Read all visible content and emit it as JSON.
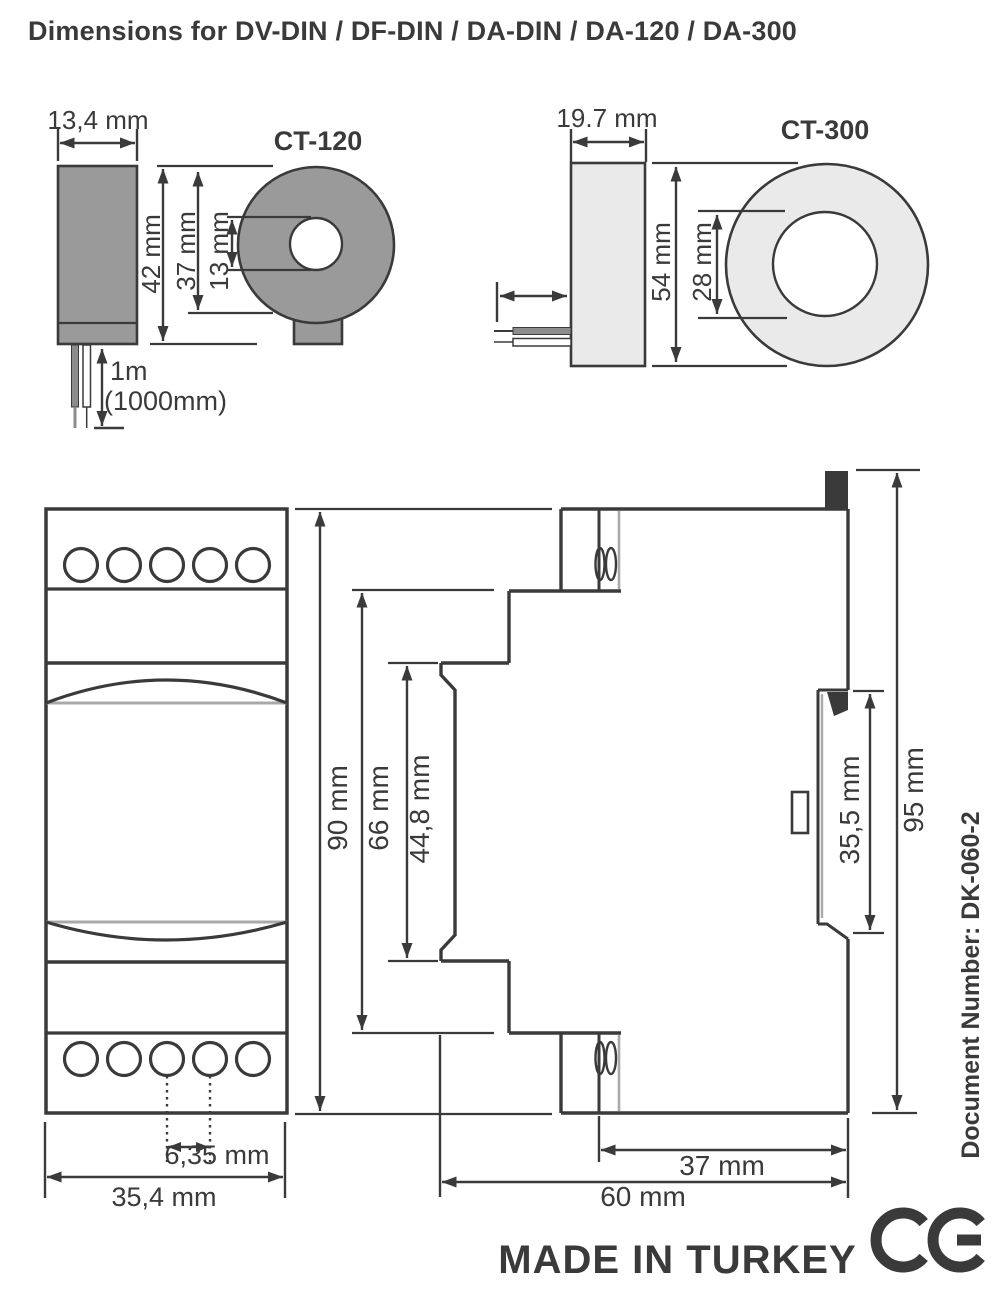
{
  "page": {
    "title": "Dimensions for DV-DIN / DF-DIN / DA-DIN / DA-120 / DA-300"
  },
  "ct120": {
    "name": "CT-120",
    "body_width": "13,4 mm",
    "outer_height": "42 mm",
    "ring_height": "37 mm",
    "hole_diameter": "13 mm",
    "cable_length": "1m",
    "cable_length_alt": "(1000mm)"
  },
  "ct300": {
    "name": "CT-300",
    "body_width": "19.7 mm",
    "outer_height": "54 mm",
    "hole_diameter": "28 mm"
  },
  "din_module": {
    "front_height": "90 mm",
    "body_height": "66 mm",
    "face_height": "44,8 mm",
    "terminal_pitch": "6,35 mm",
    "front_width": "35,4 mm",
    "rail_section_depth": "37 mm",
    "total_depth": "60 mm",
    "rail_slot_height": "35,5 mm",
    "total_height": "95 mm"
  },
  "footer": {
    "made_in": "MADE IN TURKEY",
    "document_number": "Document Number: DK-060-2",
    "ce_mark": "CE"
  },
  "colors": {
    "ink": "#3a3a3a",
    "ct120_fill": "#9a9a9a",
    "ct300_fill": "#eaeaea",
    "light_line": "#a9a9a9",
    "wire_gray": "#8c8c8c",
    "paper": "#ffffff"
  }
}
